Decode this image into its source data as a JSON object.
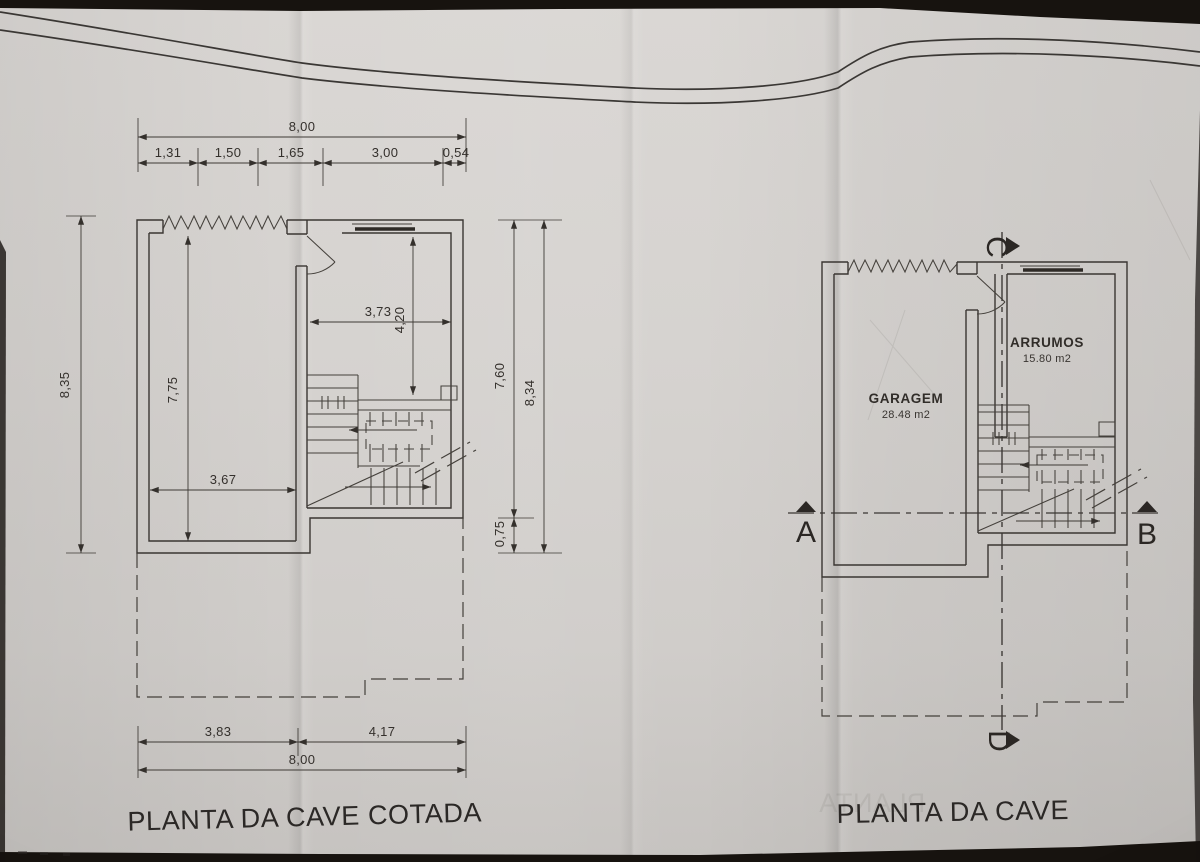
{
  "colors": {
    "backdrop": "#17130f",
    "paper": "#d6d3d0",
    "ink": "#3a3632"
  },
  "left_plan": {
    "title": "PLANTA DA CAVE COTADA",
    "top_dims": {
      "overall": "8,00",
      "segments": [
        "1,31",
        "1,50",
        "1,65",
        "3,00",
        "0,54"
      ]
    },
    "side_dims": {
      "total_height_left": "8,35",
      "garage_inner_height": "7,75",
      "upper_right": "7,60",
      "total_height_right": "8,34",
      "lower_right": "0,75"
    },
    "inner_dims": {
      "garage_inner_width": "3,67",
      "room_width": "3,73",
      "room_depth": "4,20"
    },
    "bottom_dims": {
      "left": "3,83",
      "right": "4,17",
      "overall": "8,00"
    }
  },
  "right_plan": {
    "title": "PLANTA DA CAVE",
    "rooms": {
      "garage": {
        "name": "GARAGEM",
        "area": "28.48 m2"
      },
      "storage": {
        "name": "ARRUMOS",
        "area": "15.80 m2"
      }
    },
    "sections": {
      "a": "A",
      "b": "B",
      "c": "C",
      "d": "D"
    },
    "ghost_text": "PLANTA"
  }
}
